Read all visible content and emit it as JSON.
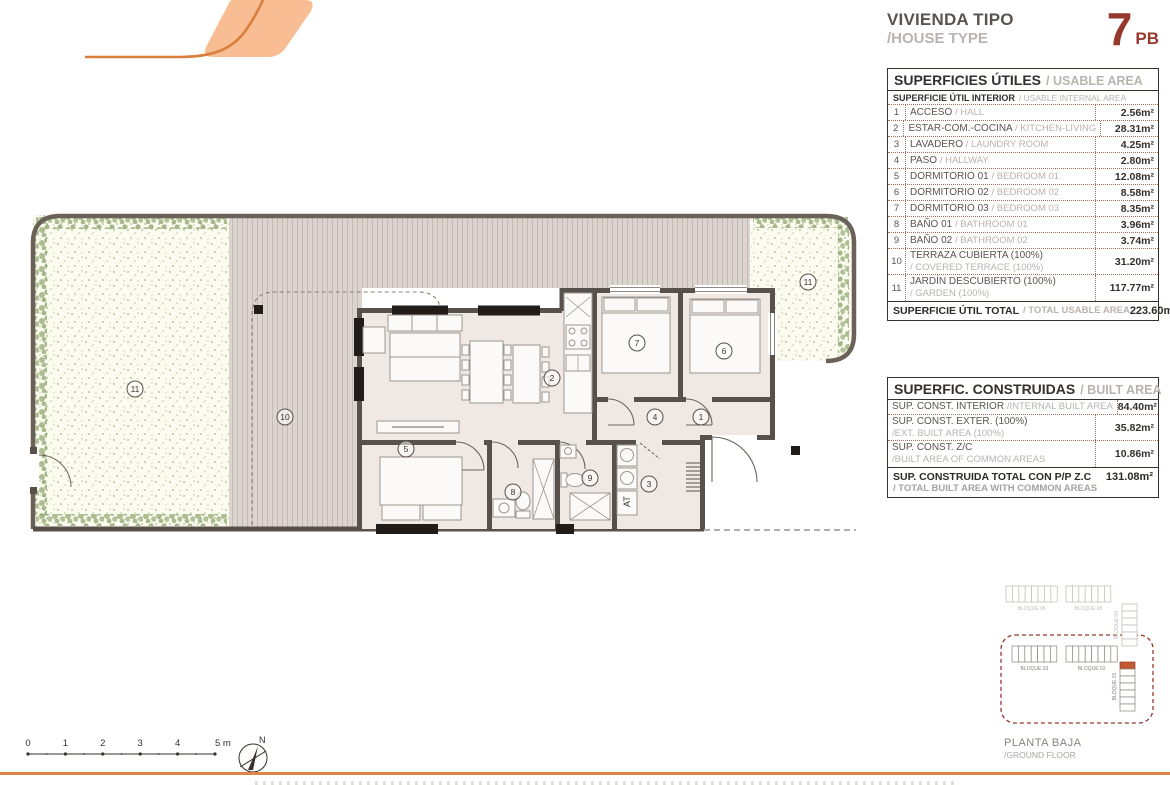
{
  "header": {
    "title_es": "VIVIENDA TIPO",
    "title_en": "/HOUSE TYPE",
    "unit_number": "7",
    "unit_floor": "PB"
  },
  "usable_table": {
    "title_es": "SUPERFICIES ÚTILES",
    "title_en": "/ USABLE AREA",
    "subtitle_es": "SUPERFICIE ÚTIL INTERIOR",
    "subtitle_en": "/ USABLE INTERNAL AREA",
    "rows": [
      {
        "num": "1",
        "es": "ACCESO",
        "en": "/ HALL",
        "value": "2.56m²",
        "two_line": false
      },
      {
        "num": "2",
        "es": "ESTAR-COM.-COCINA",
        "en": "/ KITCHEN-LIVING",
        "value": "28.31m²",
        "two_line": false
      },
      {
        "num": "3",
        "es": "LAVADERO",
        "en": "/ LAUNDRY ROOM",
        "value": "4.25m²",
        "two_line": false
      },
      {
        "num": "4",
        "es": "PASO",
        "en": "/ HALLWAY",
        "value": "2.80m²",
        "two_line": false
      },
      {
        "num": "5",
        "es": "DORMITORIO 01",
        "en": "/ BEDROOM 01",
        "value": "12.08m²",
        "two_line": false
      },
      {
        "num": "6",
        "es": "DORMITORIO 02",
        "en": "/ BEDROOM 02",
        "value": "8.58m²",
        "two_line": false
      },
      {
        "num": "7",
        "es": "DORMITORIO 03",
        "en": "/ BEDROOM 03",
        "value": "8.35m²",
        "two_line": false
      },
      {
        "num": "8",
        "es": "BAÑO 01",
        "en": "/ BATHROOM 01",
        "value": "3.96m²",
        "two_line": false
      },
      {
        "num": "9",
        "es": "BAÑO 02",
        "en": "/ BATHROOM 02",
        "value": "3.74m²",
        "two_line": false
      },
      {
        "num": "10",
        "es": "TERRAZA CUBIERTA (100%)",
        "en": "/ COVERED TERRACE (100%)",
        "value": "31.20m²",
        "two_line": true
      },
      {
        "num": "11",
        "es": "JARDÍN DESCUBIERTO (100%)",
        "en": "/ GARDEN (100%)",
        "value": "117.77m²",
        "two_line": true
      }
    ],
    "total_es": "SUPERFICIE ÚTIL TOTAL",
    "total_en": "/ TOTAL USABLE AREA",
    "total_value": "223.60m²"
  },
  "built_table": {
    "title_es": "SUPERFIC. CONSTRUIDAS",
    "title_en": "/ BUILT AREA",
    "rows": [
      {
        "es": "SUP. CONST. INTERIOR",
        "en": "/INTERNAL BUILT AREA",
        "value": "84.40m²",
        "two_line": false
      },
      {
        "es": "SUP. CONST. EXTER. (100%)",
        "en": "/EXT. BUILT AREA (100%)",
        "value": "35.82m²",
        "two_line": true
      },
      {
        "es": "SUP. CONST. Z/C",
        "en": "/BUILT AREA OF COMMON AREAS",
        "value": "10.86m²",
        "two_line": true
      }
    ],
    "total_es": "SUP. CONSTRUIDA TOTAL CON P/P Z.C",
    "total_en": "/ TOTAL BUILT AREA WITH COMMON AREAS",
    "total_value": "131.08m²"
  },
  "floor_plan": {
    "rooms": [
      {
        "num": "1",
        "x": 701,
        "y": 232
      },
      {
        "num": "2",
        "x": 552,
        "y": 193
      },
      {
        "num": "3",
        "x": 649,
        "y": 299
      },
      {
        "num": "4",
        "x": 655,
        "y": 232
      },
      {
        "num": "5",
        "x": 406,
        "y": 264
      },
      {
        "num": "6",
        "x": 724,
        "y": 166
      },
      {
        "num": "7",
        "x": 637,
        "y": 158
      },
      {
        "num": "8",
        "x": 513,
        "y": 307
      },
      {
        "num": "9",
        "x": 590,
        "y": 293
      },
      {
        "num": "10",
        "x": 285,
        "y": 232
      },
      {
        "num": "11",
        "x": 135,
        "y": 204
      },
      {
        "num": "11",
        "x": 808,
        "y": 97
      }
    ],
    "at_label": "AT"
  },
  "scale_bar": {
    "labels": [
      "0",
      "1",
      "2",
      "3",
      "4",
      "5 m"
    ]
  },
  "compass": {
    "north_label": "N"
  },
  "site_plan": {
    "caption_es": "PLANTA BAJA",
    "caption_en": "/GROUND FLOOR",
    "blocks": [
      {
        "id": "bloque-06",
        "label": "BLOQUE 06",
        "units": 8,
        "orient": "h",
        "zone": "outside"
      },
      {
        "id": "bloque-05",
        "label": "BLOQUE 05",
        "units": 7,
        "orient": "h",
        "zone": "outside"
      },
      {
        "id": "bloque-04",
        "label": "BLOQUE 04",
        "units": 6,
        "orient": "v",
        "zone": "outside"
      },
      {
        "id": "bloque-03",
        "label": "BLOQUE 03",
        "units": 7,
        "orient": "h",
        "zone": "inside"
      },
      {
        "id": "bloque-02",
        "label": "BLOQUE 02",
        "units": 8,
        "orient": "h",
        "zone": "inside"
      },
      {
        "id": "bloque-01",
        "label": "BLOQUE 01",
        "units": 7,
        "orient": "v",
        "zone": "inside",
        "highlight_unit": 0
      }
    ]
  },
  "colors": {
    "accent_orange": "#E0854A",
    "logo_fill": "#F8BD92",
    "logo_stroke": "#D97E3F",
    "maroon": "#94392B",
    "wall": "#57504B",
    "floor": "#F0E8E3",
    "stripe_bg": "#DCD4CE",
    "garden_dot": "#9FB483",
    "hedge_green": "#8CA46B",
    "boundary": "#6A6159",
    "text_dark": "#35302C",
    "text_gray": "#B9B3AD",
    "table_dotted": "#A0705B",
    "site_gray": "#C0BAB4",
    "site_dark": "#8A847E",
    "site_unit_orange": "#C25B32"
  }
}
